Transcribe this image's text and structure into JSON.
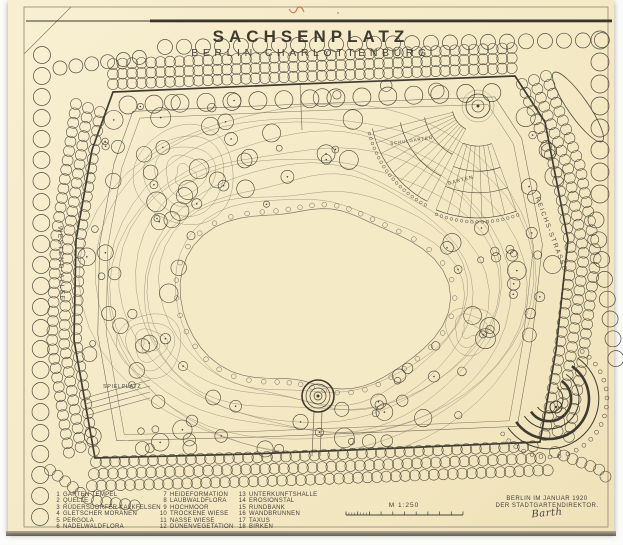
{
  "title": {
    "main": "SACHSENPLATZ",
    "sub": "BERLIN·CHARLOTTENBURG"
  },
  "streets": {
    "left": "WESTEND-ALLEE",
    "right": "REICHS-STRASSE"
  },
  "plan_labels": {
    "playground": "SPIELPLATZ",
    "school_garden": "SCHULGARTEN",
    "garden": "GARTEN"
  },
  "legend": {
    "columns": [
      {
        "items": [
          {
            "num": "1",
            "label": "GARTEN TEMPEL"
          },
          {
            "num": "2",
            "label": "QUELLE"
          },
          {
            "num": "3",
            "label": "RÜDERSDORFER KALKFELSEN"
          },
          {
            "num": "4",
            "label": "GLETSCHER MORÄNEN"
          },
          {
            "num": "5",
            "label": "PERGOLA"
          },
          {
            "num": "6",
            "label": "NADELWALDFLORA"
          }
        ]
      },
      {
        "items": [
          {
            "num": "7",
            "label": "HEIDEFORMATION"
          },
          {
            "num": "8",
            "label": "LAUBWALDFLORA"
          },
          {
            "num": "9",
            "label": "HOCHMOOR"
          },
          {
            "num": "10",
            "label": "TROCKENE WIESE"
          },
          {
            "num": "11",
            "label": "NASSE WIESE"
          },
          {
            "num": "12",
            "label": "DÜNENVEGETATION"
          }
        ]
      },
      {
        "items": [
          {
            "num": "13",
            "label": "UNTERKUNFTSHALLE"
          },
          {
            "num": "14",
            "label": "EROSIONSTAL"
          },
          {
            "num": "15",
            "label": "RUNDBANK"
          },
          {
            "num": "16",
            "label": "WANDBRUNNEN"
          },
          {
            "num": "17",
            "label": "TAXUS"
          },
          {
            "num": "18",
            "label": "BIRKEN"
          }
        ]
      }
    ]
  },
  "scale_bar": {
    "label": "M 1:250"
  },
  "imprint": {
    "line1": "BERLIN IM JANUAR 1920",
    "line2": "DER STADTGARTENDIREKTOR.",
    "signature": "Barth"
  },
  "colors": {
    "paper": "#f5eac6",
    "ink": "#45413a",
    "contour": "#8d8670",
    "accent_red": "#c05535"
  }
}
